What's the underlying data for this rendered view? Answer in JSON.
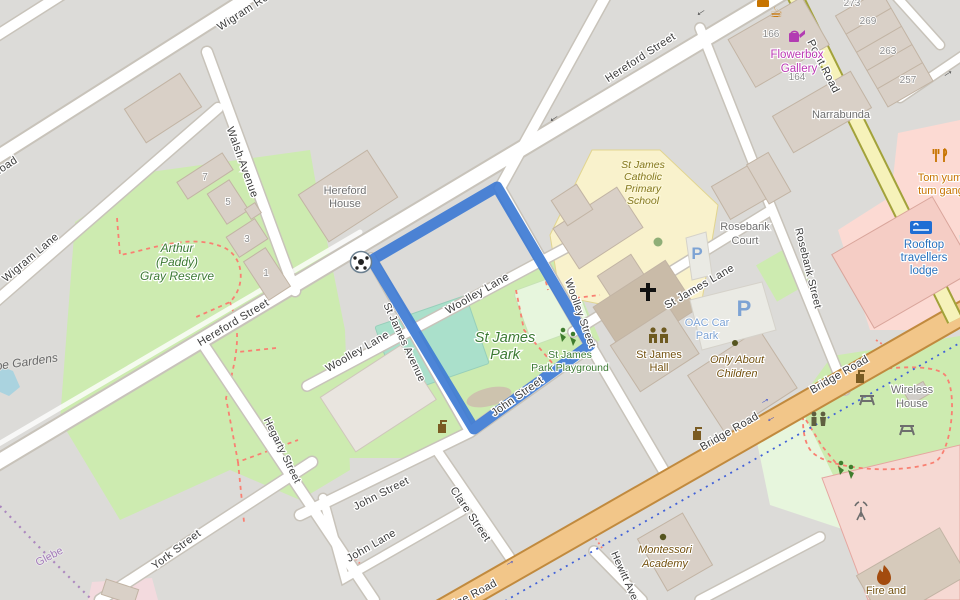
{
  "colors": {
    "route": "#3e7bd4",
    "land": "#dcdbd8",
    "road-fill": "#ffffff",
    "road-casing": "#c8c3ba",
    "bridge-fill": "#f2c689",
    "bridge-casing": "#c18a3e",
    "point-fill": "#f6f2ba",
    "point-casing": "#a2a23a",
    "park": "#cdebb0",
    "pitch": "#aae0cb",
    "playground": "#e7f6dd",
    "school": "#f9f2cc",
    "retail-pink": "#fcdad3",
    "building": "#d9d0c7",
    "building-stroke": "#c2b4a4",
    "water": "#aad3df",
    "path-red": "#f98072",
    "cycleway-blue": "#4161d8",
    "park-text": "#3c7a33",
    "poi-brown": "#73510f",
    "tourism-blue": "#2b72bd",
    "shop-magenta": "#bb38b3"
  },
  "streets": {
    "hereford": {
      "name": "Hereford Street"
    },
    "wigram_road": {
      "name": "Wigram Road"
    },
    "wigram_lane": {
      "name": "Wigram Lane"
    },
    "walsh": {
      "name": "Walsh Avenue"
    },
    "hegarty": {
      "name": "Hegarty Street"
    },
    "woolley_lane": {
      "name": "Woolley Lane"
    },
    "st_james_avenue": {
      "name": "St James Avenue"
    },
    "woolley_street": {
      "name": "Woolley Street"
    },
    "st_james_lane": {
      "name": "St James Lane"
    },
    "rosebank_street": {
      "name": "Rosebank Street"
    },
    "john_street": {
      "name": "John Street"
    },
    "clare_street": {
      "name": "Clare Street"
    },
    "john_lane": {
      "name": "John Lane"
    },
    "york_street": {
      "name": "York Street"
    },
    "bridge_road": {
      "name": "Bridge Road"
    },
    "point_road": {
      "name": "Point Road"
    },
    "hewitt_avenue": {
      "name": "Hewitt Avenue"
    }
  },
  "places": {
    "reserve": {
      "lines": [
        "Arthur",
        "(Paddy)",
        "Gray Reserve"
      ]
    },
    "st_james_park": {
      "lines": [
        "St James",
        "Park"
      ]
    },
    "playground": {
      "lines": [
        "St James",
        "Park Playground"
      ]
    },
    "school": {
      "lines": [
        "St James",
        "Catholic",
        "Primary",
        "School"
      ]
    },
    "hereford_house": {
      "lines": [
        "Hereford",
        "House"
      ]
    },
    "narrabunda": {
      "text": "Narrabunda"
    },
    "rosebank_court": {
      "lines": [
        "Rosebank",
        "Court"
      ]
    },
    "glebe_gardens": {
      "text": "Glebe Gardens"
    },
    "glebe": {
      "text": "Glebe"
    },
    "flowerbox": {
      "lines": [
        "Flowerbox",
        "Gallery"
      ]
    },
    "tom_yum": {
      "lines": [
        "Tom yum",
        "tum gang"
      ]
    },
    "rooftop": {
      "lines": [
        "Rooftop",
        "travellers",
        "lodge"
      ]
    },
    "oac": {
      "lines": [
        "OAC Car",
        "Park"
      ]
    },
    "st_james_hall": {
      "lines": [
        "St James",
        "Hall"
      ]
    },
    "only_about_children": {
      "lines": [
        "Only About",
        "Children"
      ]
    },
    "wireless_house": {
      "lines": [
        "Wireless",
        "House"
      ]
    },
    "montessori": {
      "lines": [
        "Montessori",
        "Academy"
      ]
    },
    "fire_station": {
      "text": "Fire and"
    }
  },
  "numbers": {
    "n7": "7",
    "n5": "5",
    "n3": "3",
    "n1": "1",
    "n166": "166",
    "n164": "164",
    "n273": "273",
    "n269": "269",
    "n263": "263",
    "n257": "257"
  },
  "icons": {
    "parking_letter": "P",
    "cafe_glyph": "☕",
    "arrow_left": "←",
    "arrow_right": "→"
  }
}
